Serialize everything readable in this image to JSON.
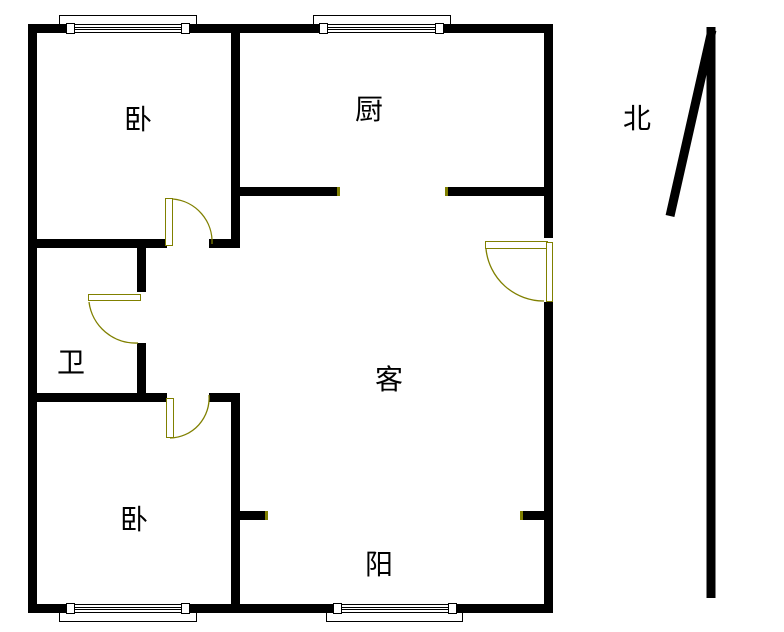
{
  "title": "apartment-floor-plan",
  "colors": {
    "wall": "#000000",
    "door": "#808000",
    "background": "#ffffff",
    "text": "#000000"
  },
  "labels": {
    "bedroom_top": "卧",
    "kitchen": "厨",
    "north": "北",
    "bathroom": "卫",
    "living_room": "客",
    "balcony": "阳",
    "bedroom_bottom": "卧"
  }
}
